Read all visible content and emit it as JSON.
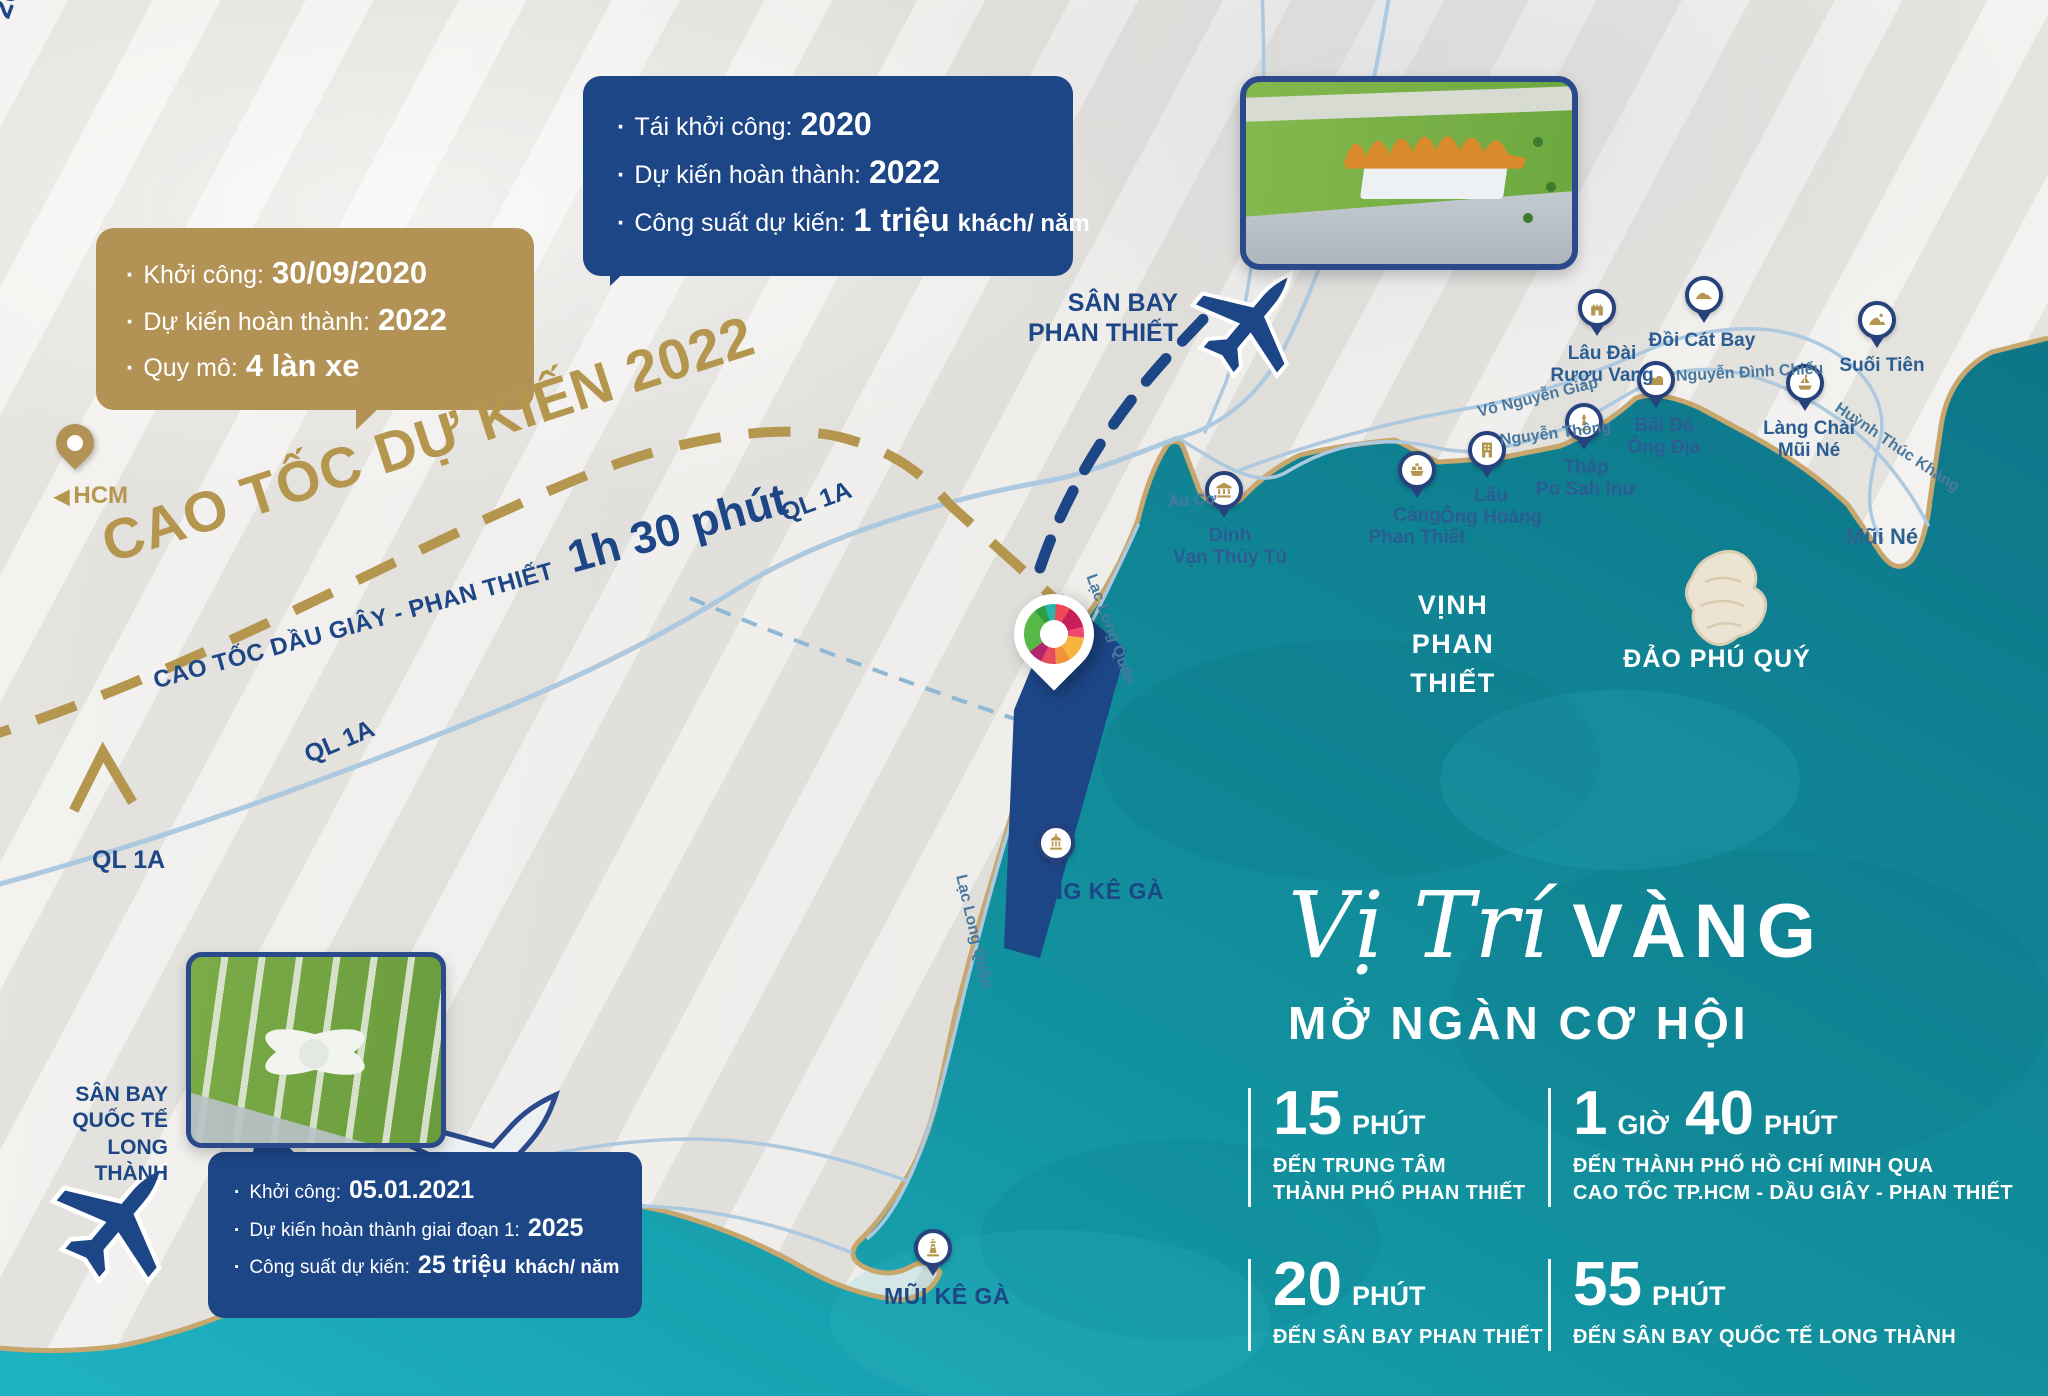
{
  "colors": {
    "gold": "#b29355",
    "gold_text": "#b5964f",
    "navy": "#1d4687",
    "sea_dark": "#0e7b8d",
    "sea_light": "#1ba8bb",
    "road": "#adc9df",
    "coast": "#c7a76e",
    "label_blue": "#2b5d92"
  },
  "boxes": {
    "expressway": {
      "items": [
        {
          "label": "Khởi công:",
          "value": "30/09/2020",
          "suffix": ""
        },
        {
          "label": "Dự kiến hoàn thành:",
          "value": "2022",
          "suffix": ""
        },
        {
          "label": "Quy mô:",
          "value": "4 làn xe",
          "suffix": ""
        }
      ]
    },
    "pt_airport": {
      "items": [
        {
          "label": "Tái khởi công:",
          "value": "2020",
          "suffix": ""
        },
        {
          "label": "Dự kiến hoàn thành:",
          "value": "2022",
          "suffix": ""
        },
        {
          "label": "Công suất dự kiến:",
          "value": "1 triệu",
          "suffix": "khách/ năm"
        }
      ]
    },
    "lt_airport": {
      "items": [
        {
          "label": "Khởi công:",
          "value": "05.01.2021",
          "suffix": ""
        },
        {
          "label": "Dự kiến hoàn thành giai đoạn 1:",
          "value": "2025",
          "suffix": ""
        },
        {
          "label": "Công suất dự kiến:",
          "value": "25 triệu",
          "suffix": "khách/ năm"
        }
      ]
    }
  },
  "labels": {
    "expwy_title": "CAO TỐC DỰ KIẾN 2022",
    "expwy_route": "CAO TỐC DẦU GIÂY - PHAN THIẾT",
    "expwy_time": "1h 30 phút",
    "hcm_arrow": "◀",
    "hcm": "HCM",
    "pt_airport": "SÂN BAY\nPHAN THIẾT",
    "route20": "20 PHÚT",
    "bay": "VỊNH\nPHAN THIẾT",
    "island": "ĐẢO PHÚ QUÝ",
    "mui_ne": "Mũi Né",
    "lt_airport": "SÂN BAY\nQUỐC TẾ\nLONG THÀNH",
    "ql1a": "QL 1A"
  },
  "ql1a_labels": [
    {
      "x": 782,
      "y": 500,
      "rot": -20
    },
    {
      "x": 306,
      "y": 742,
      "rot": -23
    },
    {
      "x": 92,
      "y": 846,
      "rot": 0
    }
  ],
  "road_labels": [
    {
      "name": "Võ Nguyễn Giáp",
      "x": 1478,
      "y": 404,
      "rot": -14
    },
    {
      "name": "Nguyễn Thông",
      "x": 1500,
      "y": 432,
      "rot": -7
    },
    {
      "name": "Nguyễn Đình Chiểu",
      "x": 1676,
      "y": 368,
      "rot": -3
    },
    {
      "name": "Huỳnh Thúc Kháng",
      "x": 1836,
      "y": 398,
      "rot": 34
    },
    {
      "name": "Âu Cơ",
      "x": 1168,
      "y": 494,
      "rot": -4
    },
    {
      "name": "Lạc Long Quân",
      "x": 1090,
      "y": 566,
      "rot": 70
    },
    {
      "name": "Lạc Long Quân",
      "x": 960,
      "y": 866,
      "rot": 77
    }
  ],
  "pois": [
    {
      "id": "dinh-van-thuy-tu",
      "name": "Dinh\nVạn Thủy Tú",
      "icon": "temple",
      "x": 1224,
      "y": 490,
      "dx": 6,
      "caps": false
    },
    {
      "id": "cang-phan-thiet",
      "name": "Cảng\nPhan Thiết",
      "icon": "ship",
      "x": 1417,
      "y": 470,
      "dx": 0,
      "caps": false
    },
    {
      "id": "lau-ong-hoang",
      "name": "Lầu\nÔng Hoàng",
      "icon": "building",
      "x": 1487,
      "y": 450,
      "dx": 4,
      "caps": false
    },
    {
      "id": "thap-po-sah-inu",
      "name": "Tháp\nPo Sah Inư",
      "icon": "tower",
      "x": 1584,
      "y": 422,
      "dx": 2,
      "caps": false
    },
    {
      "id": "bai-da-ong-dia",
      "name": "Bãi Đá\nÔng Địa",
      "icon": "rocks",
      "x": 1656,
      "y": 380,
      "dx": 8,
      "caps": false
    },
    {
      "id": "lau-dai-ruou-vang",
      "name": "Lâu Đài\nRượu Vang",
      "icon": "castle",
      "x": 1597,
      "y": 308,
      "dx": 5,
      "caps": false
    },
    {
      "id": "doi-cat-bay",
      "name": "Đồi Cát Bay",
      "icon": "dune",
      "x": 1704,
      "y": 295,
      "dx": -2,
      "caps": false
    },
    {
      "id": "suoi-tien",
      "name": "Suối Tiên",
      "icon": "spring",
      "x": 1877,
      "y": 320,
      "dx": 5,
      "caps": false
    },
    {
      "id": "lang-chai-mui-ne",
      "name": "Làng Chài\nMũi Né",
      "icon": "boat",
      "x": 1805,
      "y": 383,
      "dx": 4,
      "caps": false
    },
    {
      "id": "cang-ke-ga",
      "name": "CẢNG KÊ GÀ",
      "icon": "port",
      "x": 1056,
      "y": 843,
      "dx": 32,
      "caps": true
    },
    {
      "id": "mui-ke-ga",
      "name": "MŨI KÊ GÀ",
      "icon": "lighthouse",
      "x": 933,
      "y": 1248,
      "dx": 14,
      "caps": true
    }
  ],
  "headline": {
    "script": "Vị Trí",
    "accent": "VÀNG",
    "sub": "MỞ NGÀN CƠ HỘI"
  },
  "stats": [
    {
      "num1": "15",
      "unit1": "PHÚT",
      "num2": "",
      "unit2": "",
      "desc": "ĐẾN TRUNG TÂM\nTHÀNH PHỐ PHAN THIẾT"
    },
    {
      "num1": "1",
      "unit1": "GIỜ",
      "num2": "40",
      "unit2": "PHÚT",
      "desc": "ĐẾN THÀNH PHỐ HỒ CHÍ MINH QUA\nCAO TỐC TP.HCM - DẦU GIÂY - PHAN THIẾT"
    },
    {
      "num1": "20",
      "unit1": "PHÚT",
      "num2": "",
      "unit2": "",
      "desc": "ĐẾN SÂN BAY PHAN THIẾT"
    },
    {
      "num1": "55",
      "unit1": "PHÚT",
      "num2": "",
      "unit2": "",
      "desc": "ĐẾN SÂN BAY QUỐC TẾ LONG THÀNH"
    }
  ]
}
